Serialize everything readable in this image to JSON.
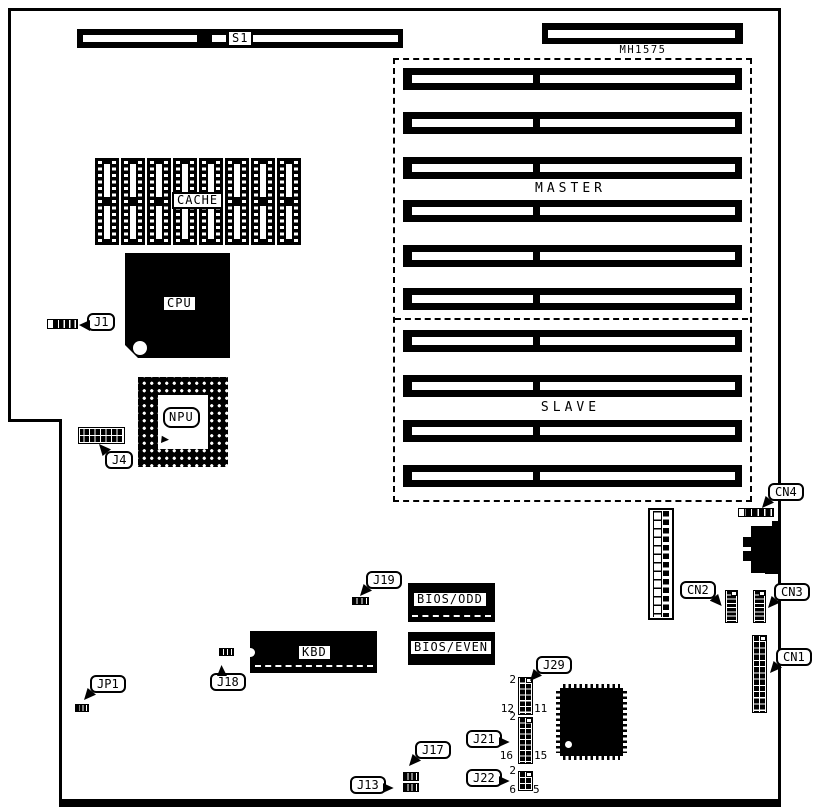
{
  "board": {
    "slots": {
      "s1_label": "S1",
      "mh_label": "MH1575",
      "master_label": "MASTER",
      "slave_label": "SLAVE"
    },
    "chips": {
      "cache": "CACHE",
      "cpu": "CPU",
      "npu": "NPU",
      "kbd": "KBD",
      "bios_odd": "BIOS/ODD",
      "bios_even": "BIOS/EVEN"
    },
    "callouts": {
      "j1": "J1",
      "j4": "J4",
      "jp1": "JP1",
      "j18": "J18",
      "j19": "J19",
      "j29": "J29",
      "j21": "J21",
      "j22": "J22",
      "j17": "J17",
      "j13": "J13",
      "cn1": "CN1",
      "cn2": "CN2",
      "cn3": "CN3",
      "cn4": "CN4"
    },
    "pins": {
      "j29": {
        "top": "2",
        "bl": "12",
        "br": "11"
      },
      "j21": {
        "top": "2",
        "bl": "16",
        "br": "15"
      },
      "j22": {
        "top": "2",
        "bl": "6",
        "br": "5"
      }
    },
    "colors": {
      "ink": "#000000",
      "paper": "#ffffff"
    }
  }
}
